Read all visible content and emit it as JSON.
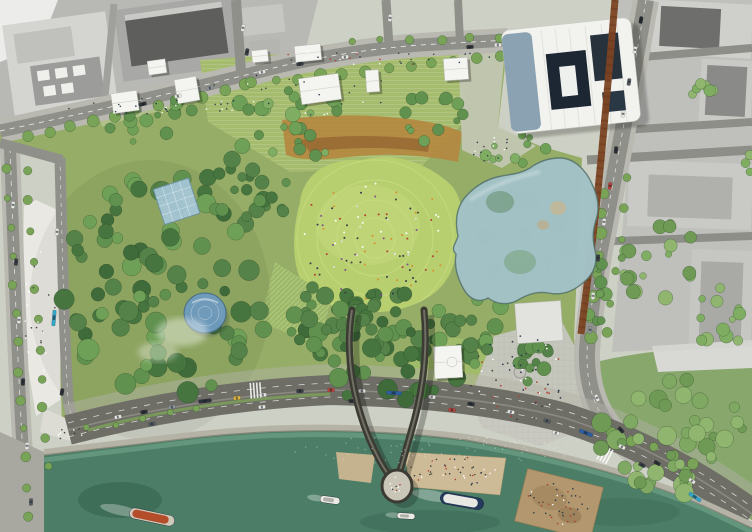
{
  "scene": {
    "kind": "aerial-masterplan-rendering",
    "description": "Aerial site-plan rendering of a riverside urban park with glass canopy structures, V-shaped pier bridge over the river, surrounding city blocks and embankment road"
  },
  "palette": {
    "ground": "#cdd0c4",
    "city": "#bfbfbc",
    "city_light": "#d6d6d3",
    "roof_dark": "#5e5e5d",
    "roof_mid": "#9c9c9a",
    "park": "#95ad67",
    "park_light": "#a5bb6e",
    "lawn": "#b7cf6f",
    "lawn_ring": "#d2e18e",
    "meadow": "#b5853f",
    "meadow_dark": "#8a5a2c",
    "plaza": "#c7c7c0",
    "plaza_bright": "#e9e8e2",
    "road": "#90908a",
    "road_major": "#6e6e67",
    "sidewalk": "#b9b9b1",
    "lane": "#ffffff",
    "river": "#4c7e67",
    "river_light": "#79ae92",
    "wall": "#b5b3a6",
    "corten": "#7c4423",
    "glass": "#a3c2c6",
    "glass_rim": "#51706a",
    "skylight": "#a6c8da",
    "dome": "#6f9cc0",
    "white_building": "#f2f2ef",
    "building_face": "#8099ab",
    "courtyard": "#1c2733",
    "bridge": "#3b3b33",
    "bridge_deck": "#7d7d70",
    "sand": "#cdbb97",
    "beach": "#b2976f",
    "stage": "#e2e3de"
  },
  "features": {
    "tree_rows": [
      {
        "x1": 28,
        "y1": 136,
        "x2": 246,
        "y2": 86,
        "n": 11,
        "r": 5,
        "seed": 11
      },
      {
        "x1": 252,
        "y1": 84,
        "x2": 500,
        "y2": 57,
        "n": 12,
        "r": 5,
        "seed": 12
      },
      {
        "x1": 352,
        "y1": 42,
        "x2": 500,
        "y2": 38,
        "n": 6,
        "r": 4,
        "seed": 13
      },
      {
        "x1": 604,
        "y1": 194,
        "x2": 590,
        "y2": 338,
        "n": 8,
        "r": 5,
        "seed": 14
      },
      {
        "x1": 628,
        "y1": 178,
        "x2": 608,
        "y2": 334,
        "n": 6,
        "r": 4,
        "seed": 15
      },
      {
        "x1": 6,
        "y1": 170,
        "x2": 28,
        "y2": 516,
        "n": 13,
        "r": 4,
        "seed": 16
      },
      {
        "x1": 27,
        "y1": 172,
        "x2": 48,
        "y2": 468,
        "n": 11,
        "r": 4,
        "seed": 17
      },
      {
        "x1": 612,
        "y1": 432,
        "x2": 694,
        "y2": 464,
        "n": 5,
        "r": 5,
        "seed": 18
      },
      {
        "x1": 88,
        "y1": 428,
        "x2": 196,
        "y2": 409,
        "n": 5,
        "r": 3,
        "seed": 19
      }
    ],
    "tree_clusters": [
      {
        "x": 165,
        "y": 283,
        "rx": 108,
        "ry": 118,
        "n": 80,
        "rmin": 5,
        "rmax": 11,
        "seed": 21,
        "colors": [
          "#3f6b3b",
          "#47753f",
          "#548248",
          "#61914f",
          "#6fa057"
        ]
      },
      {
        "x": 250,
        "y": 182,
        "rx": 55,
        "ry": 38,
        "n": 22,
        "rmin": 4,
        "rmax": 9,
        "seed": 22,
        "colors": [
          "#47753f",
          "#548248",
          "#61914f"
        ]
      },
      {
        "x": 382,
        "y": 352,
        "rx": 88,
        "ry": 50,
        "n": 50,
        "rmin": 4,
        "rmax": 10,
        "seed": 23,
        "colors": [
          "#3f6b3b",
          "#47753f",
          "#548248",
          "#61914f"
        ]
      },
      {
        "x": 320,
        "y": 314,
        "rx": 42,
        "ry": 30,
        "n": 18,
        "rmin": 4,
        "rmax": 9,
        "seed": 24,
        "colors": [
          "#47753f",
          "#548248",
          "#61914f"
        ]
      },
      {
        "x": 470,
        "y": 332,
        "rx": 42,
        "ry": 40,
        "n": 20,
        "rmin": 4,
        "rmax": 9,
        "seed": 25,
        "colors": [
          "#548248",
          "#61914f",
          "#6fa057"
        ]
      },
      {
        "x": 388,
        "y": 310,
        "rx": 30,
        "ry": 22,
        "n": 12,
        "rmin": 3,
        "rmax": 8,
        "seed": 26,
        "colors": [
          "#47753f",
          "#548248"
        ]
      },
      {
        "x": 540,
        "y": 360,
        "rx": 30,
        "ry": 25,
        "n": 12,
        "rmin": 4,
        "rmax": 9,
        "seed": 27,
        "colors": [
          "#548248",
          "#61914f"
        ]
      },
      {
        "x": 598,
        "y": 300,
        "rx": 12,
        "ry": 40,
        "n": 10,
        "rmin": 3,
        "rmax": 7,
        "seed": 28,
        "colors": [
          "#61914f",
          "#6fa057"
        ]
      },
      {
        "x": 300,
        "y": 122,
        "rx": 92,
        "ry": 34,
        "n": 26,
        "rmin": 3,
        "rmax": 8,
        "seed": 29,
        "colors": [
          "#61914f",
          "#6fa057",
          "#7fae63"
        ]
      },
      {
        "x": 150,
        "y": 120,
        "rx": 46,
        "ry": 24,
        "n": 14,
        "rmin": 3,
        "rmax": 7,
        "seed": 30,
        "colors": [
          "#61914f",
          "#6fa057"
        ]
      },
      {
        "x": 430,
        "y": 120,
        "rx": 42,
        "ry": 26,
        "n": 12,
        "rmin": 3,
        "rmax": 7,
        "seed": 31,
        "colors": [
          "#61914f",
          "#6fa057"
        ]
      },
      {
        "x": 516,
        "y": 150,
        "rx": 34,
        "ry": 16,
        "n": 10,
        "rmin": 3,
        "rmax": 6,
        "seed": 32,
        "colors": [
          "#6fa057",
          "#7fae63"
        ]
      },
      {
        "x": 660,
        "y": 262,
        "rx": 42,
        "ry": 40,
        "n": 20,
        "rmin": 3,
        "rmax": 8,
        "seed": 33,
        "colors": [
          "#7fae63",
          "#8fb56e",
          "#6f9a55"
        ]
      },
      {
        "x": 722,
        "y": 318,
        "rx": 28,
        "ry": 34,
        "n": 12,
        "rmin": 3,
        "rmax": 7,
        "seed": 34,
        "colors": [
          "#7fae63",
          "#8fb56e"
        ]
      },
      {
        "x": 700,
        "y": 90,
        "rx": 18,
        "ry": 13,
        "n": 6,
        "rmin": 3,
        "rmax": 6,
        "seed": 35,
        "colors": [
          "#7fae63",
          "#8fb56e"
        ]
      },
      {
        "x": 745,
        "y": 172,
        "rx": 13,
        "ry": 20,
        "n": 6,
        "rmin": 3,
        "rmax": 6,
        "seed": 36,
        "colors": [
          "#7fae63",
          "#8fb56e"
        ]
      },
      {
        "x": 672,
        "y": 432,
        "rx": 74,
        "ry": 62,
        "n": 45,
        "rmin": 4,
        "rmax": 10,
        "seed": 37,
        "colors": [
          "#6f9a55",
          "#7fa862",
          "#8fb56e"
        ]
      }
    ],
    "under_glass_trees": [
      {
        "x": 525,
        "y": 232,
        "rx": 56,
        "ry": 48,
        "n": 24,
        "rmin": 4,
        "rmax": 10,
        "seed": 41,
        "colors": [
          "#47753f",
          "#548248",
          "#5d8a57"
        ]
      }
    ],
    "people": [
      {
        "x": 375,
        "y": 238,
        "rx": 76,
        "ry": 62,
        "n": 95,
        "r": 1.0,
        "seed": 51,
        "colors": [
          "#ffffff",
          "#e0e0e0",
          "#b23a2e",
          "#27364a",
          "#d98c2b",
          "#3d3d3d",
          "#7a4a8c"
        ]
      },
      {
        "x": 520,
        "y": 378,
        "rx": 52,
        "ry": 42,
        "n": 55,
        "r": 0.9,
        "seed": 52,
        "colors": [
          "#3d3d3d",
          "#ffffff",
          "#27364a",
          "#b23a2e"
        ]
      },
      {
        "x": 150,
        "y": 106,
        "rx": 92,
        "ry": 8,
        "n": 26,
        "r": 0.8,
        "seed": 53,
        "colors": [
          "#3d3d3d",
          "#ffffff",
          "#27364a"
        ]
      },
      {
        "x": 385,
        "y": 57,
        "rx": 120,
        "ry": 8,
        "n": 30,
        "r": 0.8,
        "seed": 54,
        "colors": [
          "#3d3d3d",
          "#ffffff",
          "#27364a",
          "#b23a2e"
        ]
      },
      {
        "x": 455,
        "y": 471,
        "rx": 46,
        "ry": 15,
        "n": 45,
        "r": 0.8,
        "seed": 55,
        "colors": [
          "#5b4a36",
          "#ffffff",
          "#b23a2e",
          "#27364a",
          "#3d3d3d"
        ]
      },
      {
        "x": 558,
        "y": 504,
        "rx": 33,
        "ry": 21,
        "n": 40,
        "r": 0.8,
        "seed": 56,
        "colors": [
          "#5b4a36",
          "#ffffff",
          "#b23a2e",
          "#27364a"
        ]
      },
      {
        "x": 300,
        "y": 96,
        "rx": 112,
        "ry": 24,
        "n": 25,
        "r": 0.8,
        "seed": 57,
        "colors": [
          "#3d3d3d",
          "#ffffff",
          "#27364a"
        ]
      },
      {
        "x": 40,
        "y": 305,
        "rx": 16,
        "ry": 78,
        "n": 22,
        "r": 0.8,
        "seed": 58,
        "colors": [
          "#3d3d3d",
          "#ffffff"
        ]
      },
      {
        "x": 397,
        "y": 484,
        "rx": 7,
        "ry": 11,
        "n": 10,
        "r": 0.8,
        "seed": 59,
        "colors": [
          "#3d3d3d",
          "#ffffff",
          "#b23a2e"
        ]
      },
      {
        "x": 492,
        "y": 150,
        "rx": 26,
        "ry": 14,
        "n": 15,
        "r": 0.8,
        "seed": 60,
        "colors": [
          "#3d3d3d",
          "#ffffff",
          "#27364a"
        ]
      },
      {
        "x": 75,
        "y": 435,
        "rx": 18,
        "ry": 8,
        "n": 10,
        "r": 0.8,
        "seed": 61,
        "colors": [
          "#3d3d3d",
          "#ffffff"
        ]
      },
      {
        "x": 430,
        "y": 450,
        "rx": 150,
        "ry": 14,
        "n": 70,
        "r": 0.6,
        "seed": 62,
        "opacity": 0.45,
        "colors": [
          "#ffffff"
        ]
      }
    ],
    "pavilions": [
      {
        "x": 112,
        "y": 92,
        "w": 26,
        "h": 20,
        "rot": -8
      },
      {
        "x": 148,
        "y": 60,
        "w": 18,
        "h": 14,
        "rot": -8
      },
      {
        "x": 176,
        "y": 78,
        "w": 22,
        "h": 24,
        "rot": -10
      },
      {
        "x": 252,
        "y": 50,
        "w": 16,
        "h": 12,
        "rot": -6
      },
      {
        "x": 295,
        "y": 45,
        "w": 26,
        "h": 16,
        "rot": -6
      },
      {
        "x": 300,
        "y": 76,
        "w": 40,
        "h": 26,
        "rot": -8
      },
      {
        "x": 366,
        "y": 70,
        "w": 13,
        "h": 22,
        "rot": -4
      },
      {
        "x": 444,
        "y": 58,
        "w": 24,
        "h": 22,
        "rot": -4
      },
      {
        "x": 434,
        "y": 346,
        "w": 28,
        "h": 32,
        "rot": -3
      }
    ],
    "cars": [
      {
        "x": 143,
        "y": 104,
        "rot": -14,
        "c": "#2e3236"
      },
      {
        "x": 178,
        "y": 96,
        "rot": -13,
        "c": "#e6e6e3"
      },
      {
        "x": 210,
        "y": 88,
        "rot": -12,
        "c": "#8f949a"
      },
      {
        "x": 262,
        "y": 72,
        "rot": -10,
        "c": "#e6e6e3"
      },
      {
        "x": 300,
        "y": 64,
        "rot": -8,
        "c": "#3a3f45"
      },
      {
        "x": 345,
        "y": 57,
        "rot": -6,
        "c": "#e6e6e3"
      },
      {
        "x": 470,
        "y": 47,
        "rot": -3,
        "c": "#2e3236"
      },
      {
        "x": 498,
        "y": 45,
        "rot": -2,
        "c": "#e6e6e3"
      },
      {
        "x": 243,
        "y": 28,
        "rot": 100,
        "c": "#e6e6e3"
      },
      {
        "x": 247,
        "y": 52,
        "rot": 100,
        "c": "#3a3f45"
      },
      {
        "x": 390,
        "y": 18,
        "rot": 96,
        "c": "#e6e6e3"
      },
      {
        "x": 641,
        "y": 20,
        "rot": 100,
        "c": "#26292d"
      },
      {
        "x": 635,
        "y": 50,
        "rot": 100,
        "c": "#e6e6e3"
      },
      {
        "x": 629,
        "y": 82,
        "rot": 99,
        "c": "#555a60"
      },
      {
        "x": 623,
        "y": 114,
        "rot": 98,
        "c": "#e6e6e3"
      },
      {
        "x": 616,
        "y": 150,
        "rot": 97,
        "c": "#2e3236"
      },
      {
        "x": 610,
        "y": 186,
        "rot": 96,
        "c": "#b8433a"
      },
      {
        "x": 604,
        "y": 222,
        "rot": 95,
        "c": "#e6e6e3"
      },
      {
        "x": 598,
        "y": 258,
        "rot": 94,
        "c": "#3a3f45"
      },
      {
        "x": 593,
        "y": 296,
        "rot": 93,
        "c": "#e6e6e3"
      },
      {
        "x": 590,
        "y": 330,
        "rot": 92,
        "c": "#8f949a"
      },
      {
        "x": 597,
        "y": 398,
        "rot": 65,
        "c": "#e6e6e3"
      },
      {
        "x": 621,
        "y": 430,
        "rot": 48,
        "c": "#2e3236"
      },
      {
        "x": 13,
        "y": 205,
        "rot": 95,
        "c": "#e6e6e3"
      },
      {
        "x": 16,
        "y": 262,
        "rot": 95,
        "c": "#3a3f45"
      },
      {
        "x": 19,
        "y": 320,
        "rot": 94,
        "c": "#e6e6e3"
      },
      {
        "x": 23,
        "y": 382,
        "rot": 93,
        "c": "#2e3236"
      },
      {
        "x": 27,
        "y": 446,
        "rot": 93,
        "c": "#e6e6e3"
      },
      {
        "x": 31,
        "y": 502,
        "rot": 92,
        "c": "#555a60"
      },
      {
        "x": 57,
        "y": 232,
        "rot": 95,
        "c": "#e6e6e3"
      },
      {
        "x": 54,
        "y": 318,
        "rot": 95,
        "c": "#35a3c6",
        "l": 16
      },
      {
        "x": 62,
        "y": 392,
        "rot": 100,
        "c": "#2e3236"
      },
      {
        "x": 118,
        "y": 417,
        "rot": -11,
        "c": "#e6e6e3"
      },
      {
        "x": 144,
        "y": 412,
        "rot": -10,
        "c": "#2e3236"
      },
      {
        "x": 172,
        "y": 407,
        "rot": -9,
        "c": "#8f949a"
      },
      {
        "x": 205,
        "y": 401,
        "rot": -7,
        "c": "#30343a",
        "l": 13
      },
      {
        "x": 237,
        "y": 398,
        "rot": -6,
        "c": "#e0b73c"
      },
      {
        "x": 263,
        "y": 395,
        "rot": -5,
        "c": "#e6e6e3"
      },
      {
        "x": 300,
        "y": 391,
        "rot": -2,
        "c": "#3a3f45"
      },
      {
        "x": 331,
        "y": 390,
        "rot": -1,
        "c": "#b8433a"
      },
      {
        "x": 362,
        "y": 391,
        "rot": 1,
        "c": "#e6e6e3"
      },
      {
        "x": 394,
        "y": 393,
        "rot": 3,
        "c": "#2d5fa0",
        "l": 15
      },
      {
        "x": 432,
        "y": 397,
        "rot": 6,
        "c": "#e6e6e3"
      },
      {
        "x": 471,
        "y": 404,
        "rot": 9,
        "c": "#2e3236"
      },
      {
        "x": 511,
        "y": 412,
        "rot": 12,
        "c": "#e6e6e3"
      },
      {
        "x": 547,
        "y": 421,
        "rot": 16,
        "c": "#555a60"
      },
      {
        "x": 586,
        "y": 433,
        "rot": 21,
        "c": "#2d5fa0",
        "l": 14
      },
      {
        "x": 622,
        "y": 447,
        "rot": 26,
        "c": "#e6e6e3"
      },
      {
        "x": 657,
        "y": 463,
        "rot": 30,
        "c": "#2e3236"
      },
      {
        "x": 692,
        "y": 481,
        "rot": 33,
        "c": "#e6e6e3"
      },
      {
        "x": 152,
        "y": 424,
        "rot": -10,
        "c": "#555a60"
      },
      {
        "x": 262,
        "y": 407,
        "rot": -5,
        "c": "#e6e6e3"
      },
      {
        "x": 352,
        "y": 401,
        "rot": 0,
        "c": "#2e3236"
      },
      {
        "x": 452,
        "y": 410,
        "rot": 7,
        "c": "#b8433a"
      },
      {
        "x": 556,
        "y": 433,
        "rot": 17,
        "c": "#e6e6e3"
      },
      {
        "x": 642,
        "y": 465,
        "rot": 28,
        "c": "#3a3f45"
      },
      {
        "x": 695,
        "y": 497,
        "rot": 34,
        "c": "#35a3c6",
        "l": 14
      }
    ],
    "boats": [
      {
        "x": 152,
        "y": 517,
        "l": 46,
        "w": 11,
        "rot": 12,
        "hull": "#cfc9bb",
        "deck": "#b44e2a"
      },
      {
        "x": 462,
        "y": 501,
        "l": 44,
        "w": 12,
        "rot": 10,
        "hull": "#24395c",
        "deck": "#e8e8e2"
      },
      {
        "x": 330,
        "y": 500,
        "l": 20,
        "w": 7,
        "rot": 8,
        "hull": "#eceae4",
        "deck": "#b0b0aa"
      },
      {
        "x": 406,
        "y": 516,
        "l": 18,
        "w": 6,
        "rot": 4,
        "hull": "#eceae4",
        "deck": "#b0b0aa"
      }
    ]
  }
}
